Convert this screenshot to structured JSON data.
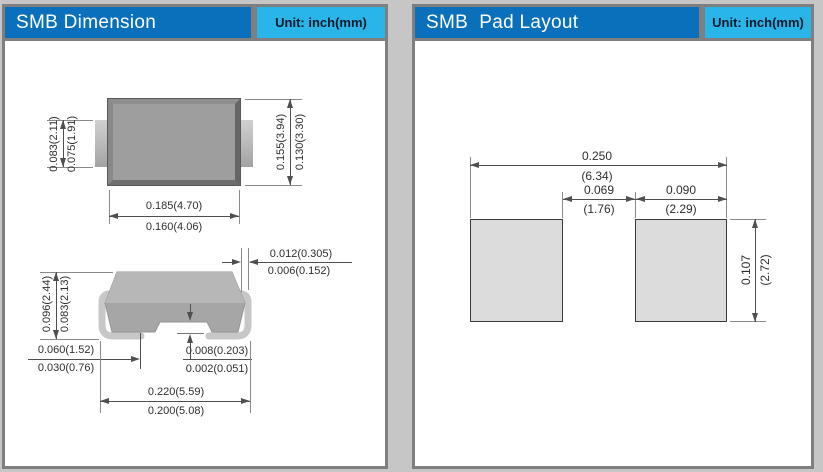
{
  "left_panel": {
    "title": "SMB Dimension",
    "unit": "Unit: inch(mm)",
    "top_view": {
      "lead_width_max": "0.083(2.11)",
      "lead_width_min": "0.075(1.91)",
      "body_width_max": "0.185(4.70)",
      "body_width_min": "0.160(4.06)",
      "body_height_max": "0.155(3.94)",
      "body_height_min": "0.130(3.30)"
    },
    "side_view": {
      "height_max": "0.096(2.44)",
      "height_min": "0.083(2.13)",
      "lead_thickness_max": "0.012(0.305)",
      "lead_thickness_min": "0.006(0.152)",
      "foot_length_max": "0.060(1.52)",
      "foot_length_min": "0.030(0.76)",
      "standoff_max": "0.008(0.203)",
      "standoff_min": "0.002(0.051)",
      "overall_length_max": "0.220(5.59)",
      "overall_length_min": "0.200(5.08)"
    }
  },
  "right_panel": {
    "title": "SMB  Pad Layout",
    "unit": "Unit: inch(mm)",
    "pad_layout": {
      "overall_width_inch": "0.250",
      "overall_width_mm": "(6.34)",
      "gap_inch": "0.069",
      "gap_mm": "(1.76)",
      "pad_width_inch": "0.090",
      "pad_width_mm": "(2.29)",
      "pad_height_inch": "0.107",
      "pad_height_mm": "(2.72)"
    }
  },
  "colors": {
    "header_blue": "#0b70bc",
    "header_cyan": "#29b5e8",
    "frame_gray": "#7f7f7f",
    "panel_bg": "#ffffff",
    "body_gray": "#9e9e9e",
    "pad_fill": "#dcdcdc"
  }
}
